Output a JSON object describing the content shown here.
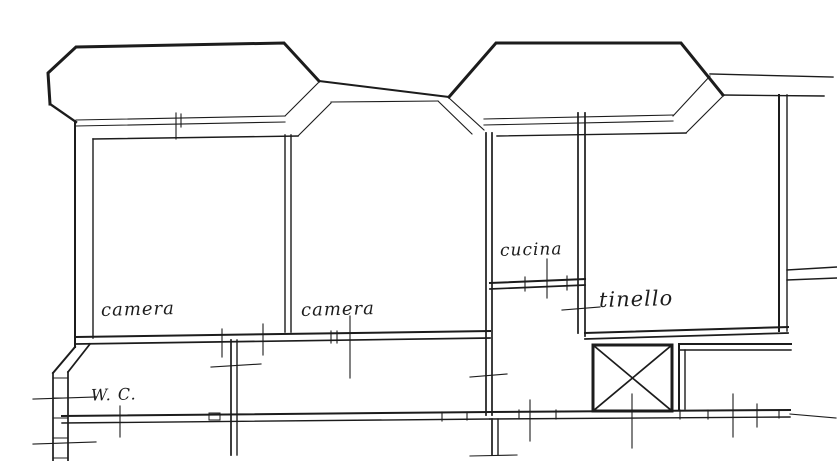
{
  "plan": {
    "kind": "scanned floor plan drawing",
    "background_color": "#ffffff",
    "ink_color": "#1c1c1c"
  },
  "rooms": [
    {
      "id": "camera-left",
      "label": "camera"
    },
    {
      "id": "camera-middle",
      "label": "camera"
    },
    {
      "id": "cucina",
      "label": "cucina"
    },
    {
      "id": "tinello",
      "label": "tinello"
    },
    {
      "id": "wc",
      "label": "W. C."
    }
  ]
}
